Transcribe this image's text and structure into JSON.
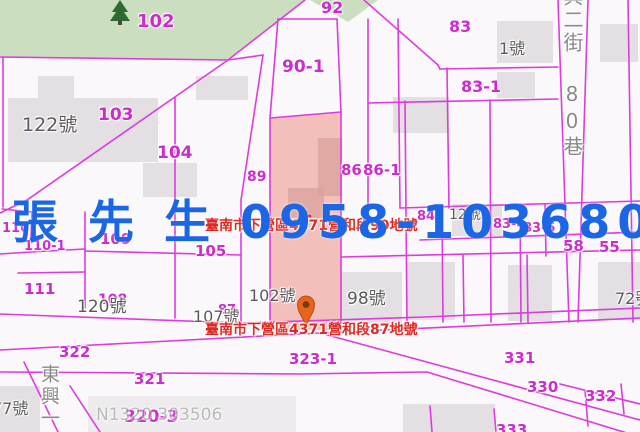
{
  "colors": {
    "bg": "#faf8fa",
    "line": "#dd3cdd",
    "parcel": "#cc2ccc",
    "house": "#5a5a5a",
    "street": "#8a8a8a",
    "red": "#e02823",
    "blue": "#1b66e6",
    "green": "#cbdec0",
    "tree": "#2e6b33",
    "highlight": "#e77064",
    "building": "#e3dfe3",
    "pin": "#e8641c"
  },
  "overlay": {
    "contact": "張 先 生 0958-103680"
  },
  "annotations": [
    {
      "id": "parcel-90",
      "text": "臺南市下營區4371營和段90地號",
      "x": 205,
      "y": 219
    },
    {
      "id": "parcel-87",
      "text": "臺南市下營區4371營和段87地號",
      "x": 205,
      "y": 323
    }
  ],
  "parcel_labels": [
    {
      "t": "102",
      "x": 137,
      "y": 13,
      "fs": 18
    },
    {
      "t": "103",
      "x": 98,
      "y": 107,
      "fs": 17
    },
    {
      "t": "104",
      "x": 157,
      "y": 145,
      "fs": 17
    },
    {
      "t": "92",
      "x": 321,
      "y": 0,
      "fs": 16
    },
    {
      "t": "90-1",
      "x": 282,
      "y": 59,
      "fs": 17
    },
    {
      "t": "83",
      "x": 449,
      "y": 19,
      "fs": 16
    },
    {
      "t": "83-1",
      "x": 461,
      "y": 79,
      "fs": 16
    },
    {
      "t": "86",
      "x": 341,
      "y": 163,
      "fs": 15
    },
    {
      "t": "86-1",
      "x": 363,
      "y": 163,
      "fs": 15
    },
    {
      "t": "89",
      "x": 247,
      "y": 170,
      "fs": 14
    },
    {
      "t": "84",
      "x": 417,
      "y": 210,
      "fs": 13
    },
    {
      "t": "83-4",
      "x": 493,
      "y": 218,
      "fs": 13
    },
    {
      "t": "83-5",
      "x": 523,
      "y": 222,
      "fs": 13
    },
    {
      "t": "58",
      "x": 563,
      "y": 239,
      "fs": 15
    },
    {
      "t": "55",
      "x": 599,
      "y": 240,
      "fs": 15
    },
    {
      "t": "110",
      "x": 2,
      "y": 222,
      "fs": 13
    },
    {
      "t": "110-1",
      "x": 24,
      "y": 240,
      "fs": 13
    },
    {
      "t": "109",
      "x": 100,
      "y": 232,
      "fs": 15
    },
    {
      "t": "105",
      "x": 195,
      "y": 244,
      "fs": 15
    },
    {
      "t": "111",
      "x": 24,
      "y": 282,
      "fs": 15
    },
    {
      "t": "108",
      "x": 98,
      "y": 293,
      "fs": 14
    },
    {
      "t": "87",
      "x": 218,
      "y": 304,
      "fs": 13
    },
    {
      "t": "322",
      "x": 59,
      "y": 345,
      "fs": 15
    },
    {
      "t": "321",
      "x": 134,
      "y": 372,
      "fs": 15
    },
    {
      "t": "323-1",
      "x": 289,
      "y": 352,
      "fs": 15
    },
    {
      "t": "331",
      "x": 504,
      "y": 351,
      "fs": 15
    },
    {
      "t": "330",
      "x": 527,
      "y": 380,
      "fs": 15
    },
    {
      "t": "332",
      "x": 585,
      "y": 389,
      "fs": 15
    },
    {
      "t": "320-3",
      "x": 124,
      "y": 409,
      "fs": 17
    },
    {
      "t": "333",
      "x": 496,
      "y": 423,
      "fs": 15
    }
  ],
  "house_numbers": [
    {
      "t": "122號",
      "x": 22,
      "y": 116,
      "fs": 19
    },
    {
      "t": "1號",
      "x": 499,
      "y": 41,
      "fs": 16
    },
    {
      "t": "12號",
      "x": 449,
      "y": 208,
      "fs": 14
    },
    {
      "t": "102號",
      "x": 249,
      "y": 288,
      "fs": 16
    },
    {
      "t": "98號",
      "x": 347,
      "y": 291,
      "fs": 17
    },
    {
      "t": "72號",
      "x": 615,
      "y": 291,
      "fs": 16
    },
    {
      "t": "120號",
      "x": 77,
      "y": 299,
      "fs": 17
    },
    {
      "t": "107號",
      "x": 193,
      "y": 309,
      "fs": 16
    },
    {
      "t": "77號",
      "x": -8,
      "y": 401,
      "fs": 16
    }
  ],
  "streets": [
    {
      "t": "興二街 80巷",
      "x": 561,
      "y": -14,
      "fs": 20
    },
    {
      "t": "東興一",
      "x": 38,
      "y": 364,
      "fs": 19
    }
  ],
  "watermark": {
    "text": "N1320 303506",
    "x": 96,
    "y": 407,
    "fs": 17
  }
}
